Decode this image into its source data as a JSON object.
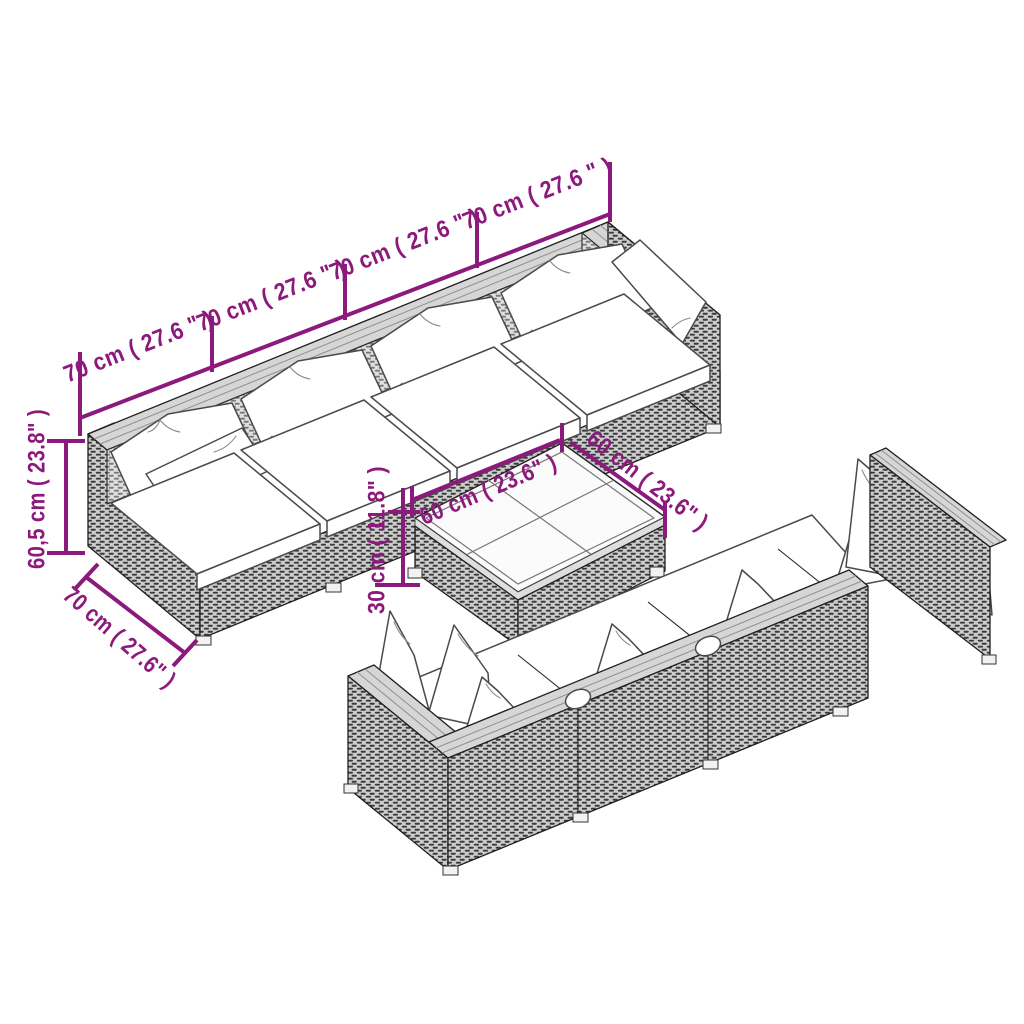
{
  "accent_color": "#8C1A7C",
  "background_color": "#FFFFFF",
  "figure": {
    "kind": "product dimension diagram",
    "subject": "modular poly-rattan garden lounge set (two sofa rows with white cushions and a square coffee table), black-and-white line art with magenta dimension lines"
  },
  "dimensions": {
    "sofa_section_width_labels": [
      "70 cm ( 27.6 \" )",
      "70 cm ( 27.6 \" )",
      "70 cm ( 27.6 \" )",
      "70 cm ( 27.6 \" )"
    ],
    "sofa_height_label": "60,5 cm ( 23.8\" )",
    "sofa_depth_label": "70 cm ( 27.6\" )",
    "table_width_label": "60 cm ( 23.6\" )",
    "table_depth_label": "60 cm ( 23.6\" )",
    "table_height_label": "30 cm ( 11.8\" )"
  }
}
